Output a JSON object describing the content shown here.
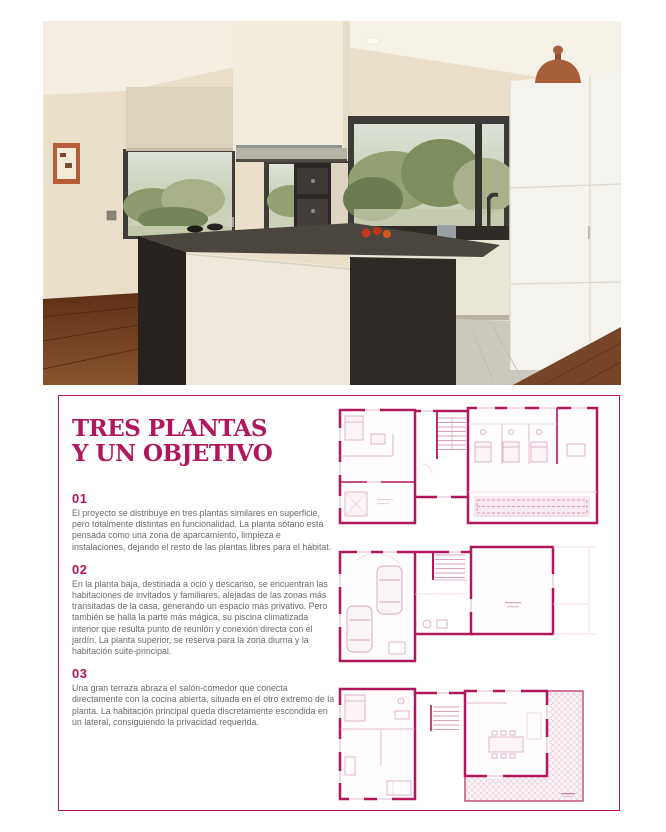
{
  "page": {
    "type": "magazine-article-page",
    "background": "#ffffff"
  },
  "hero_photo": {
    "description": "Open-plan kitchen with dark stone island, white column extractor hood, panoramic window onto green landscape and white full-height cabinets"
  },
  "article": {
    "title_line1": "TRES PLANTAS",
    "title_line2": "Y UN OBJETIVO",
    "sections": [
      {
        "number": "01",
        "text": "El proyecto se distribuye en tres plantas similares en superficie, pero totalmente distintas en funcionalidad. La planta sótano está pensada como una zona de aparcamiento, limpieza e instalaciones, dejando el resto de las plantas libres para el hábitat."
      },
      {
        "number": "02",
        "text": "En la planta baja, destinada a ocio y descanso, se encuentran las habitaciones de invitados y familiares, alejadas de las zonas más transitadas de la casa, generando un espacio más privativo. Pero también se halla la parte más mágica, su piscina climatizada interior que resulta punto de reunión y conexión directa con el jardín. La planta superior, se reserva para la zona diurna y la habitación suite-principal."
      },
      {
        "number": "03",
        "text": "Una gran terraza abraza el salón-comedor que conecta directamente con la cocina abierta, situada en el otro extremo de la planta. La habitación principal queda discretamente escondida en un lateral, consiguiendo la privacidad requerida."
      }
    ]
  },
  "floor_plans": [
    {
      "name": "floor-plan-top"
    },
    {
      "name": "floor-plan-middle"
    },
    {
      "name": "floor-plan-bottom"
    }
  ],
  "colors": {
    "accent": "#b0175c",
    "body_text": "#6e6a67",
    "plan_detail": "#d9a2bd",
    "plan_faint": "#ecd3df",
    "pool_fill": "#f7e9f0"
  }
}
